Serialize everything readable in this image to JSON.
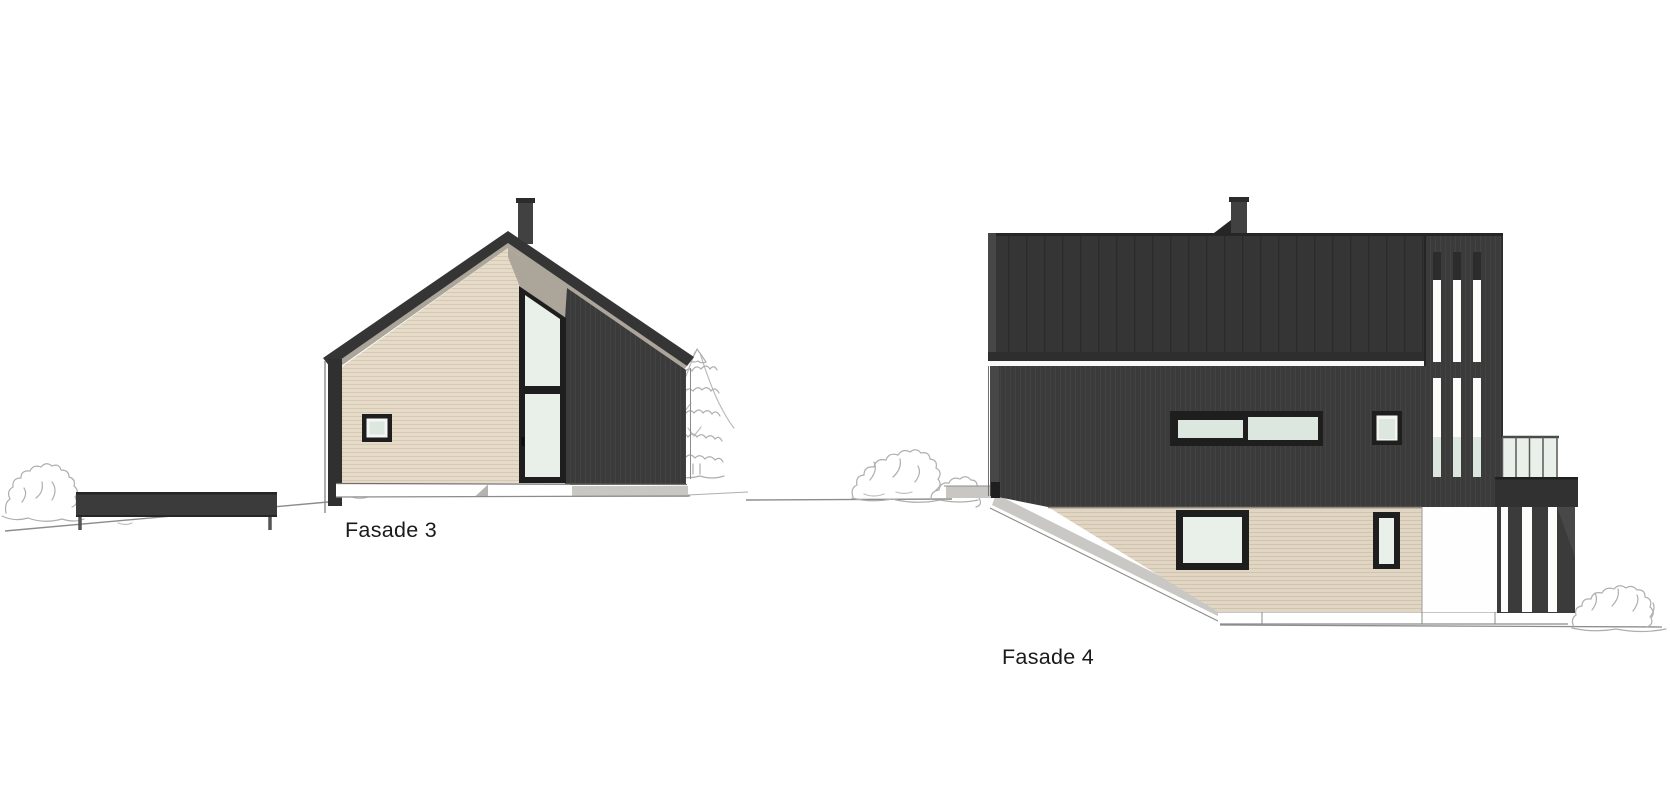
{
  "page": {
    "background": "#ffffff"
  },
  "drawings": [
    {
      "id": "fasade-3",
      "label": "Fasade 3",
      "elements": [
        "gable-roof",
        "chimney",
        "beige-gable-wall",
        "tall-window-door",
        "small-square-window",
        "dark-side-wall",
        "corner-post",
        "foundation-strip",
        "carport-deck",
        "bush",
        "pine-tree"
      ]
    },
    {
      "id": "fasade-4",
      "label": "Fasade 4",
      "elements": [
        "mono-roof",
        "chimney",
        "dark-upper-wall",
        "horizontal-window-band",
        "small-square-window",
        "beige-lower-wall",
        "lower-window",
        "narrow-window",
        "slat-screen-tower",
        "balcony-glass-railing",
        "under-balcony-slats",
        "sloped-foundation",
        "bushes"
      ]
    }
  ],
  "colors": {
    "white": "#ffffff",
    "dark": "#3b3b3b",
    "dark-line": "#444444",
    "roof": "#353535",
    "roof-seam": "#2b2b2b",
    "fascia": "#2e2e2e",
    "frame": "#1e1e1e",
    "beige": "#e6dbc9",
    "beige-line": "#d6c9b4",
    "beige2": "#e1d5c3",
    "beige2-line": "#d1c4af",
    "glass": "#e9efe9",
    "glass2": "#dce7df",
    "soffit": "#aca59a",
    "foundation": "#c8c7c4",
    "edge-light": "#474747",
    "chimney": "#414141",
    "line": "#8c8c8a",
    "sketch": "#aeaeac",
    "label": "#1a1a1a"
  }
}
